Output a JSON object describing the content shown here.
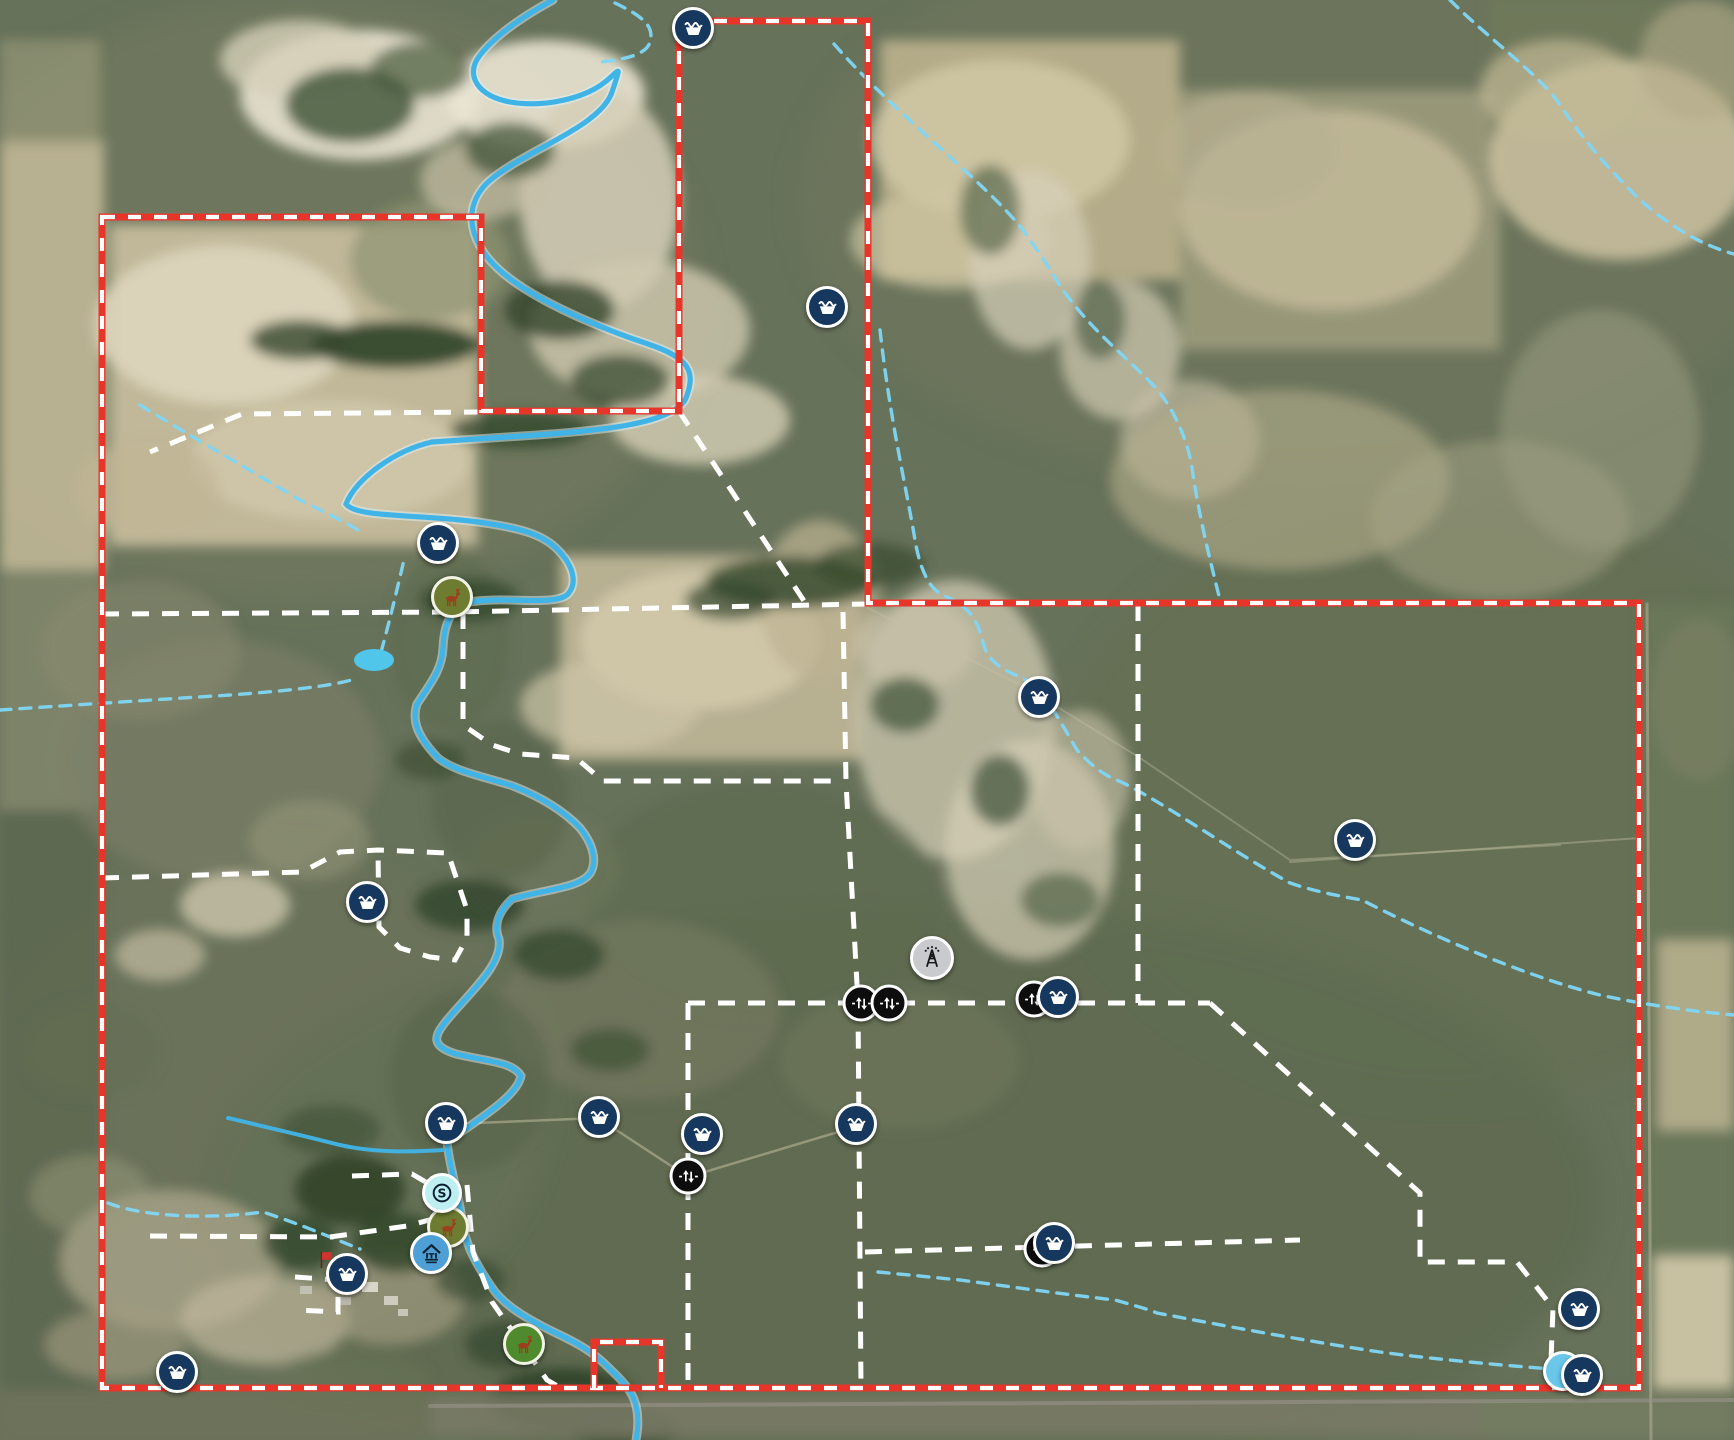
{
  "map": {
    "width": 1734,
    "height": 1440,
    "styles": {
      "boundary_red": {
        "color": "#e8352a",
        "width": 7,
        "dash_color": "#ffffff",
        "dash_width": 4.2,
        "dash": "13 13"
      },
      "fence_white": {
        "color": "#ffffff",
        "width": 5,
        "dash": "17 13"
      },
      "stream_dashed": {
        "color": "#7fd6f4",
        "width": 3.4,
        "dash": "11 9"
      },
      "creek": {
        "color": "#41b4e7",
        "width": 5.2,
        "halo_color": "#dff2f8",
        "halo_width": 9,
        "halo_opacity": 0.5
      },
      "pond_color": "#4fc6ea"
    },
    "boundary": {
      "main": "M102 217 L481 217 L481 411 L679 411 L679 21 L868 21 L868 603 L1639 603 L1639 1388 L102 1388 Z",
      "spur": "M594 1388 L594 1342 L661 1342 L661 1388"
    },
    "fences": [
      {
        "d": "M102 614 L452 612 L868 604"
      },
      {
        "d": "M481 412 L242 414 L150 452"
      },
      {
        "d": "M679 411 L806 604"
      },
      {
        "d": "M843 612 L846 782 L858 1003 L861 1388"
      },
      {
        "d": "M463 612 L463 725 L492 745 L520 754 L576 758 L603 781 L843 781"
      },
      {
        "d": "M688 1003 L1210 1003"
      },
      {
        "d": "M688 1003 L688 1388"
      },
      {
        "d": "M1138 604 L1138 1003"
      },
      {
        "d": "M1210 1003 L1420 1193 L1420 1262 L1517 1262 L1553 1308 L1550 1388"
      },
      {
        "d": "M150 1236 L330 1237 L407 1226 L455 1213"
      },
      {
        "d": "M865 1252 L1042 1247 L1300 1240"
      },
      {
        "d": "M102 878 L302 872 L340 852 L378 850 L448 853 L467 910 L467 938 L455 960 L430 957 L400 948 L379 927 L378 850"
      },
      {
        "d": "M467 1185 L473 1252 L492 1302 L547 1380 L561 1388"
      },
      {
        "d": "M352 1176 L412 1174 L436 1188"
      },
      {
        "d": "M295 1277 L338 1280 L338 1312 L295 1310"
      }
    ],
    "water": {
      "creek": "M553 0 C520 18 492 38 478 58 C466 76 478 96 510 102 C545 108 585 98 605 82 C620 70 622 62 612 92 C600 128 520 152 487 183 C462 208 468 244 504 274 C538 302 600 328 648 344 C690 358 696 372 686 398 C674 424 600 431 522 436 C492 438 460 440 432 442 C396 450 356 478 346 504 C356 518 420 514 478 522 C520 528 542 534 557 549 C574 566 578 584 567 595 C552 606 506 596 470 602 C452 607 444 622 443 648 C442 670 430 684 417 704 C411 722 419 738 438 758 C456 772 482 776 513 786 C536 795 561 808 580 828 C593 844 597 860 591 872 C582 888 546 889 512 899 C497 913 494 927 499 939 C503 964 472 990 447 1020 C433 1037 431 1046 456 1054 C490 1062 513 1062 521 1076 C517 1096 482 1117 447 1142 C449 1164 457 1188 461 1213 C464 1239 471 1257 491 1286 C501 1302 519 1314 542 1326 C560 1336 586 1344 610 1369 C630 1388 643 1402 636 1440",
      "tributary": "M228 1118 C270 1128 305 1136 340 1145 C375 1153 412 1152 443 1150",
      "streams_dashed": [
        "M834 44 C900 120 1000 193 1030 240 C1050 268 1056 280 1061 287 C1090 330 1130 360 1155 387 C1175 410 1190 445 1193 475 C1200 520 1210 560 1220 600",
        "M880 330 C890 420 906 486 915 540 C920 570 930 590 943 595 C965 605 977 615 983 643 C990 668 1012 672 1030 682 C1050 700 1066 732 1077 750 C1095 770 1110 778 1119 781 C1160 800 1230 850 1290 883 C1320 893 1345 897 1362 900 C1420 930 1520 975 1600 995 C1650 1006 1700 1012 1734 1015",
        "M1450 0 C1490 40 1540 75 1560 105 C1590 150 1620 180 1640 200 C1680 235 1712 248 1734 254",
        "M0 710 C60 706 150 700 230 695 C285 691 335 686 358 678",
        "M381 652 C390 620 398 585 404 560",
        "M140 405 C180 430 250 470 300 500 C330 515 345 522 358 530",
        "M108 1203 C140 1216 205 1220 263 1212 C300 1224 332 1238 360 1249",
        "M878 1272 C920 1276 940 1278 960 1280 C1020 1288 1070 1295 1115 1300 C1140 1307 1150 1310 1157 1313 C1220 1325 1300 1340 1380 1352 C1440 1360 1520 1367 1592 1372",
        "M615 3 C640 15 655 25 650 42 C646 56 620 60 600 62"
      ],
      "pond": {
        "cx": 374,
        "cy": 660,
        "rx": 20,
        "ry": 11
      }
    },
    "roads": [
      {
        "d": "M1647 604 L1651 1440",
        "c": "#b7b198",
        "w": 3,
        "o": 0.55
      },
      {
        "d": "M430 1406 L1734 1400",
        "c": "#97958b",
        "w": 4,
        "o": 0.6
      },
      {
        "d": "M452 1124 L598 1118 L688 1177 L858 1126",
        "c": "#c9c3a6",
        "w": 2.5,
        "o": 0.5
      },
      {
        "d": "M868 608 L1030 690 L1140 758 L1290 860 L1560 845",
        "c": "#c9c3a6",
        "w": 2,
        "o": 0.35
      },
      {
        "d": "M1290 862 L1640 838",
        "c": "#c9c3a6",
        "w": 2,
        "o": 0.4
      }
    ],
    "marker_styles": {
      "trough": {
        "d": 42,
        "bg": "#16375e",
        "ring": "#ffffff"
      },
      "gate": {
        "d": 37,
        "bg": "#0d0d0d",
        "ring": "#ffffff"
      },
      "tower": {
        "d": 44,
        "bg": "#c9cacd",
        "ring": "#ffffff"
      },
      "deer_olive": {
        "d": 42,
        "bg": "#6d7c30",
        "ring": "#f2f3e4"
      },
      "deer_green": {
        "d": 42,
        "bg": "#4f8a2e",
        "ring": "#f2f3e4"
      },
      "station_s": {
        "d": 40,
        "bg": "#bdeef0",
        "ring": "#ffffff"
      },
      "well": {
        "d": 42,
        "bg": "#4d9fd6",
        "ring": "#ffffff"
      },
      "water": {
        "d": 40,
        "bg": "#69c7ea",
        "ring": "#ffffff"
      }
    },
    "markers": [
      {
        "type": "water",
        "x": 1563,
        "y": 1371
      },
      {
        "type": "gate",
        "x": 1034,
        "y": 999
      },
      {
        "type": "gate",
        "x": 1042,
        "y": 1249
      },
      {
        "type": "trough",
        "x": 693,
        "y": 28
      },
      {
        "type": "trough",
        "x": 827,
        "y": 307
      },
      {
        "type": "trough",
        "x": 438,
        "y": 543
      },
      {
        "type": "deer_olive",
        "x": 452,
        "y": 597
      },
      {
        "type": "trough",
        "x": 1039,
        "y": 697
      },
      {
        "type": "trough",
        "x": 1355,
        "y": 840
      },
      {
        "type": "trough",
        "x": 367,
        "y": 902
      },
      {
        "type": "tower",
        "x": 932,
        "y": 958
      },
      {
        "type": "gate",
        "x": 861,
        "y": 1003
      },
      {
        "type": "gate",
        "x": 889,
        "y": 1003
      },
      {
        "type": "trough",
        "x": 1058,
        "y": 997
      },
      {
        "type": "trough",
        "x": 599,
        "y": 1117
      },
      {
        "type": "trough",
        "x": 446,
        "y": 1123
      },
      {
        "type": "trough",
        "x": 702,
        "y": 1134
      },
      {
        "type": "trough",
        "x": 856,
        "y": 1124
      },
      {
        "type": "gate",
        "x": 688,
        "y": 1176
      },
      {
        "type": "deer_olive",
        "x": 448,
        "y": 1227
      },
      {
        "type": "station_s",
        "x": 442,
        "y": 1193
      },
      {
        "type": "well",
        "x": 431,
        "y": 1253
      },
      {
        "type": "trough",
        "x": 1054,
        "y": 1243
      },
      {
        "type": "flag",
        "x": 327,
        "y": 1262
      },
      {
        "type": "trough",
        "x": 347,
        "y": 1274
      },
      {
        "type": "trough",
        "x": 177,
        "y": 1372
      },
      {
        "type": "trough",
        "x": 1579,
        "y": 1309
      },
      {
        "type": "trough",
        "x": 1582,
        "y": 1375
      },
      {
        "type": "deer_green",
        "x": 524,
        "y": 1344
      }
    ]
  }
}
